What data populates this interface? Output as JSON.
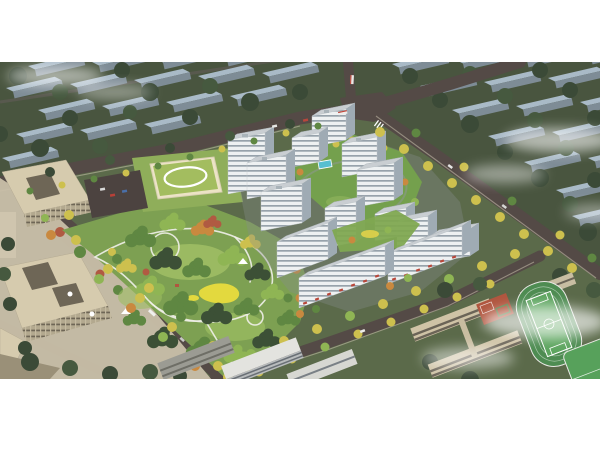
{
  "meta": {
    "domain": "Natural-Image",
    "description": "Aerial bird's-eye architectural rendering of a new residential development: a cluster of white high-rise apartment towers around a green landscaped courtyard, a large central park with winding white paths and a yellow playground, a kindergarten with a green roof, beige office buildings on the left, a school campus with a green sports field and red basketball courts at the lower right, tree-lined roads, rows of muted blue-grey context apartment blocks in the background, and wisps of white cloud."
  },
  "frame": {
    "page_background": "#ffffff",
    "photo_top_px": 62,
    "photo_height_px": 317,
    "photo_width_px": 600
  },
  "scene": {
    "view": "high-angle aerial oblique",
    "time_of_day": "daytime",
    "residential_tower_count": 11,
    "regions": [
      {
        "name": "background-city",
        "desc": "rows of blue-grey context apartment slabs on dark green tree cover, upper band"
      },
      {
        "name": "central-park",
        "desc": "dense mixed-green park with looping white footpaths and yellow play area"
      },
      {
        "name": "residential-cluster",
        "desc": "white towers with dark horizontal window bands around a podium garden with pool"
      },
      {
        "name": "commercial-street",
        "desc": "low slabs with red shopfront awnings along the south edge of the cluster"
      },
      {
        "name": "kindergarten",
        "desc": "cream building with light-green roof and white oval loop"
      },
      {
        "name": "office-towers",
        "desc": "beige courtyard office blocks and paved plaza on the left"
      },
      {
        "name": "school-campus",
        "desc": "beige teaching blocks, green running-track field, red basketball courts, lower right"
      },
      {
        "name": "boulevard",
        "desc": "wide tree-lined avenue separating offices from the park"
      },
      {
        "name": "clouds",
        "desc": "soft white fog wisps top-left, right and bottom-right"
      }
    ]
  },
  "colors": {
    "page_bg": "#ffffff",
    "ground": "#5b6a4a",
    "background_ground": "#49553f",
    "context_roof": "#a9bac7",
    "context_wall": "#7e8c96",
    "road": "#544a46",
    "sidewalk": "#cbc2ae",
    "park_base": "#7da052",
    "lawn_light": "#a3c166",
    "tree_dark": "#3c5036",
    "tree_mid": "#5f8742",
    "tree_light": "#8fb554",
    "tree_yellow": "#cdc04e",
    "tree_orange": "#c9893f",
    "tree_red": "#b05a42",
    "path_white": "#f1f0ea",
    "playground_yellow": "#e3d93e",
    "tower_facade": "#eef1f2",
    "tower_window": "#97a2ab",
    "tower_side": "#9fabb4",
    "tower_roof": "#c9ced2",
    "podium_green": "#74a04d",
    "pool_blue": "#58bfd0",
    "kindergarten_roof": "#a3bd5f",
    "kindergarten_wall": "#ece3c6",
    "office_roof": "#d6cbae",
    "office_wall": "#9a9078",
    "plaza": "#c9bfa9",
    "school_wall": "#cfc3a6",
    "track_green": "#4e8c52",
    "field_green": "#5da55f",
    "court_red": "#b0563f",
    "shopfront_red": "#b8473a",
    "cloud": "#ffffff"
  }
}
